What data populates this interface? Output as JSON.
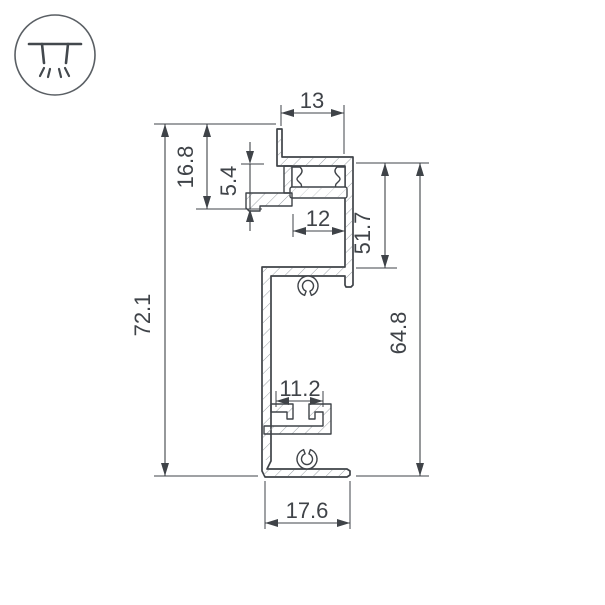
{
  "icons": {
    "badge": "recessed-downlight-icon"
  },
  "colors": {
    "background": "#ffffff",
    "line": "#3f4348",
    "hatch": "#9aa0a5"
  },
  "drawing": {
    "type": "aluminium-led-profile-cross-section",
    "dimensions": {
      "top_width": "13",
      "lip_inset": "5.4",
      "lip_height": "16.8",
      "diffuser_opening": "12",
      "upper_section_height": "51.7",
      "total_height": "72.1",
      "body_height": "64.8",
      "mount_slot_width": "11.2",
      "base_width": "17.6"
    }
  }
}
